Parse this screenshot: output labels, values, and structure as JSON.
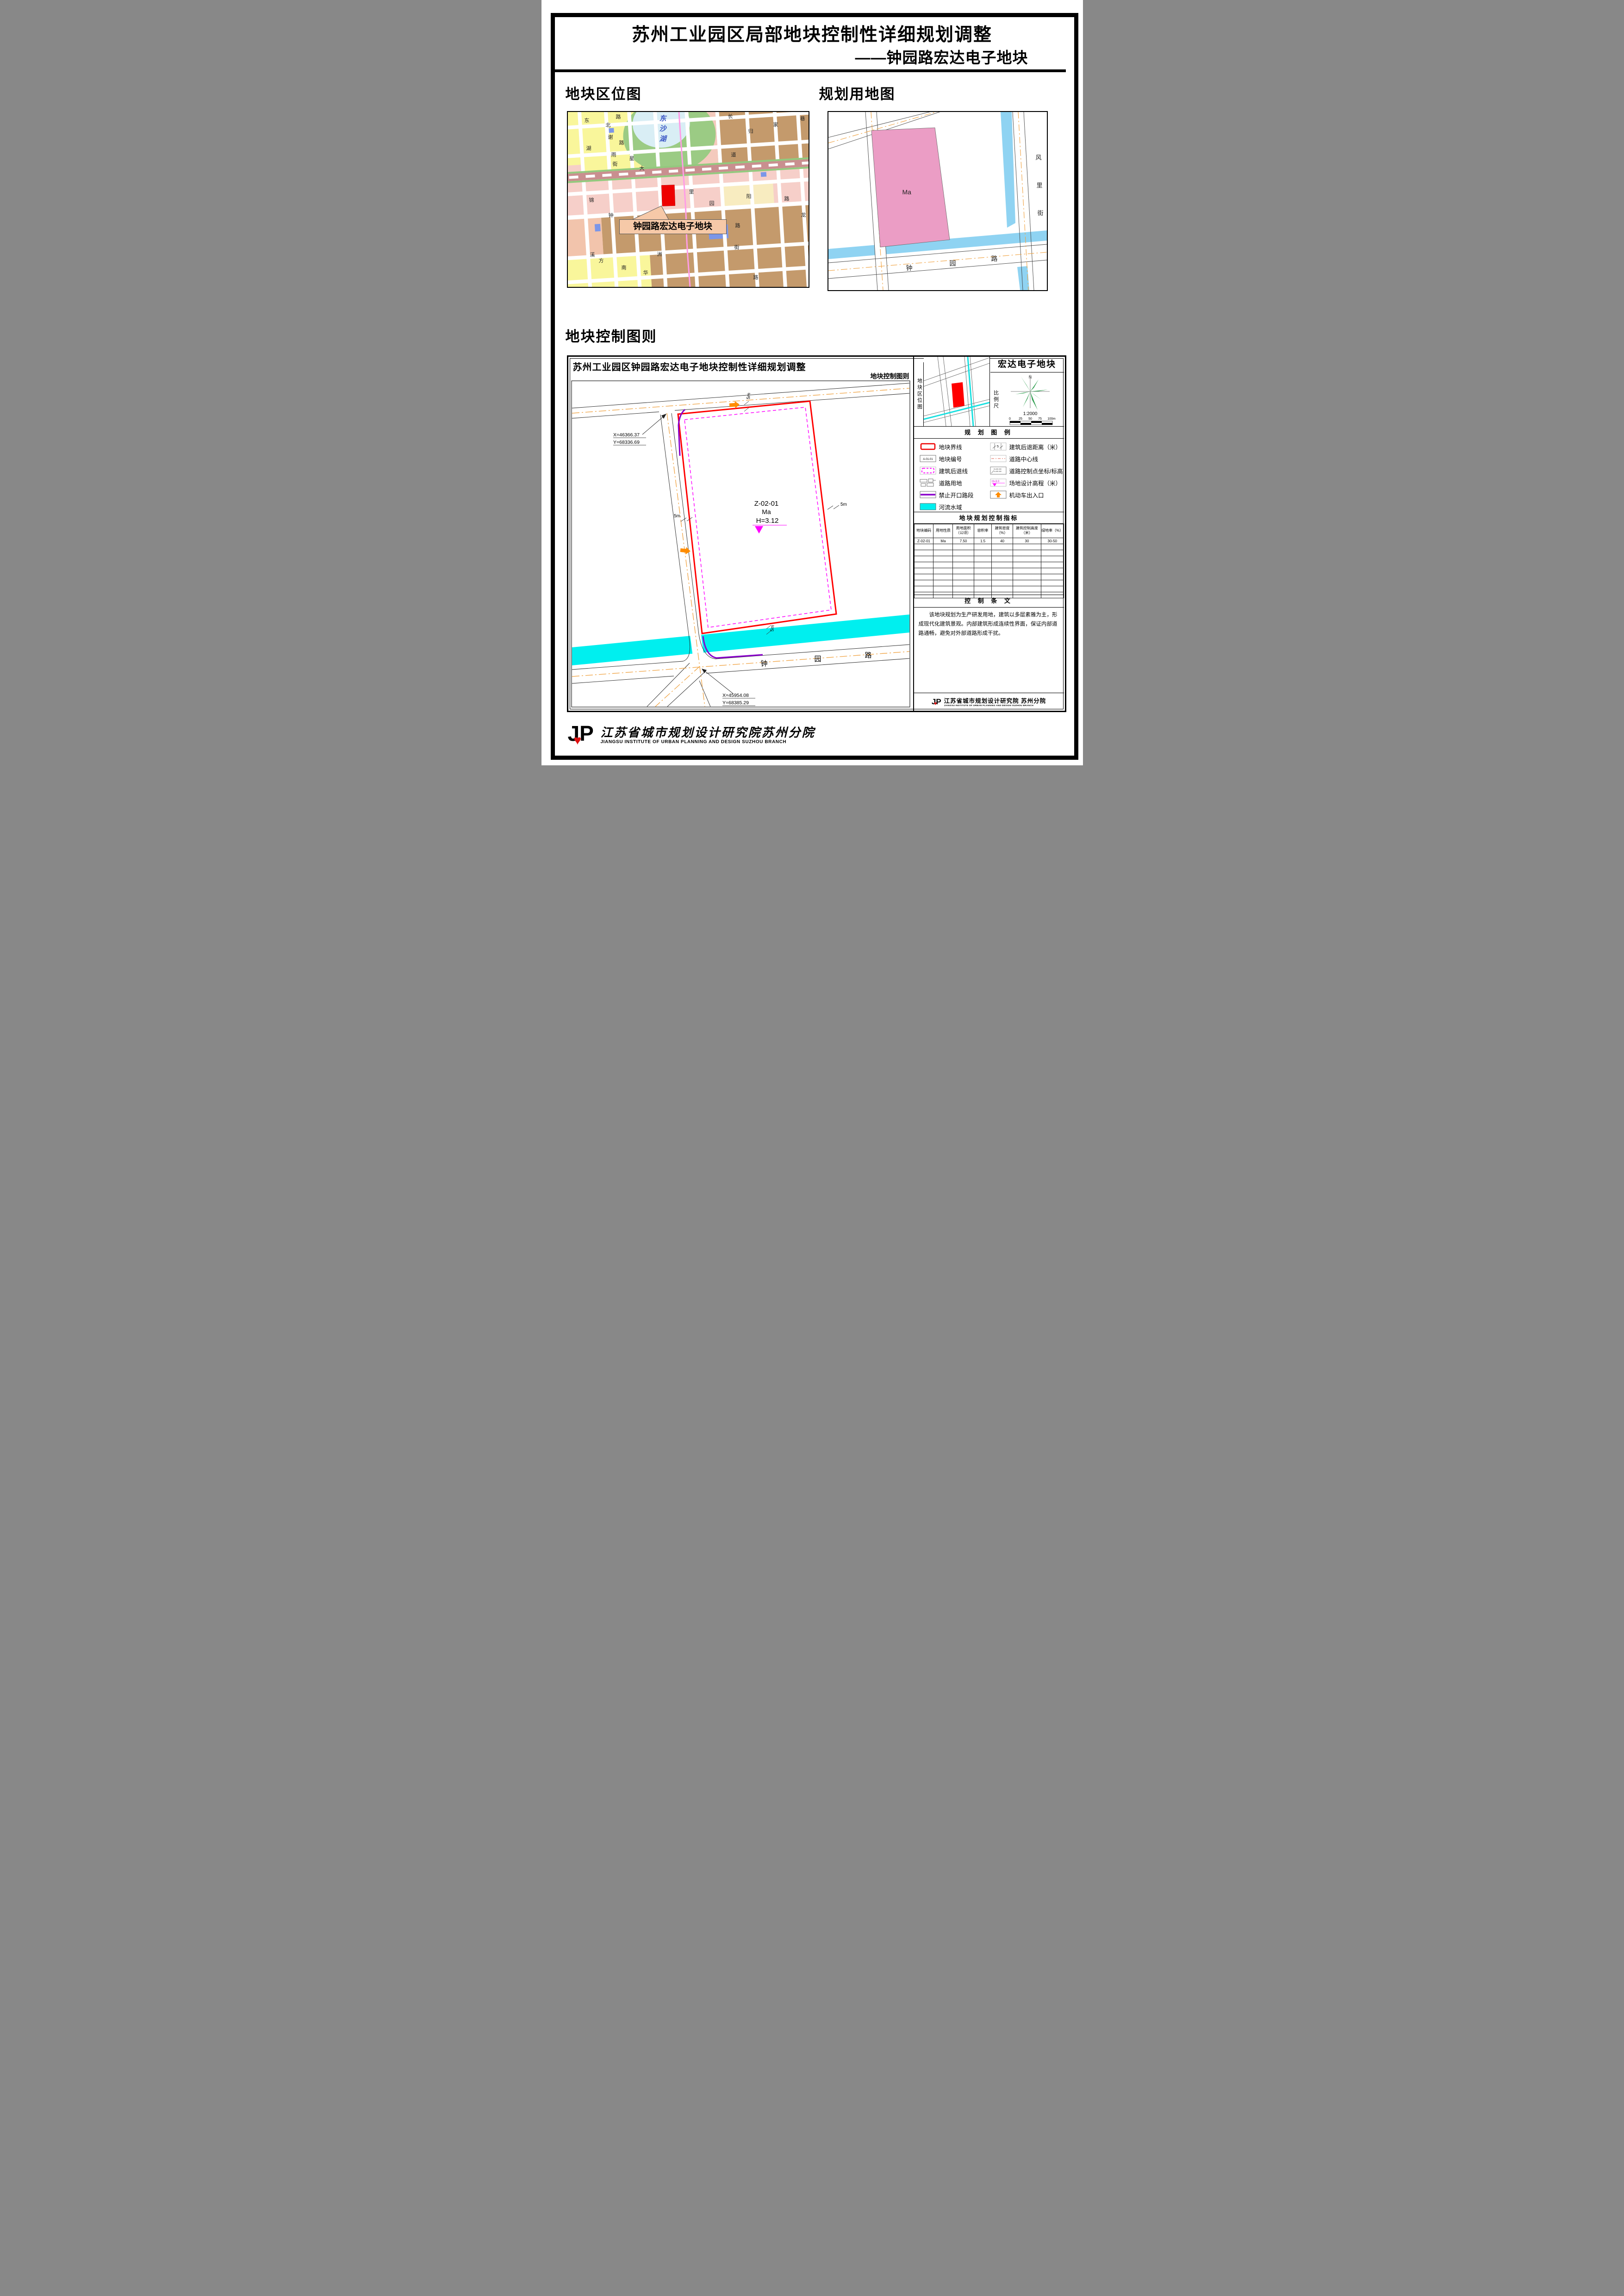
{
  "colors": {
    "plot_boundary_red": "#ff0000",
    "setback_magenta": "#ff00ff",
    "no_access_purple": "#8a00cc",
    "entrance_orange": "#ff8c00",
    "water_cyan": "#00efef",
    "canal_blue": "#8fd3f2",
    "landuse_pink": "#eb9dc5",
    "centerline_orange": "#f0a240",
    "lake_cyan": "#d9eef5",
    "parcel_brown": "#c49a6c",
    "parcel_yellow": "#f9f69b"
  },
  "header": {
    "title": "苏州工业园区局部地块控制性详细规划调整",
    "subtitle": "——钟园路宏达电子地块"
  },
  "location_map": {
    "section_title": "地块区位图",
    "lake_label": "东沙湖",
    "callout": "钟园路宏达电子地块",
    "street_labels": [
      "东",
      "路",
      "北",
      "谢",
      "路",
      "湖",
      "雨",
      "街",
      "星",
      "大",
      "道",
      "长",
      "归",
      "家",
      "巷",
      "里",
      "园",
      "阳",
      "路",
      "龙",
      "钟",
      "锦",
      "路",
      "街",
      "溪",
      "方",
      "南",
      "华",
      "洲",
      "路"
    ]
  },
  "landuse_map": {
    "section_title": "规划用地图",
    "plot_label": "Ma",
    "street_vertical": [
      "风",
      "里",
      "街"
    ],
    "street_bottom": [
      "钟",
      "园",
      "路"
    ]
  },
  "control_chart": {
    "section_title": "地块控制图则",
    "drawing_title": "苏州工业园区钟园路宏达电子地块控制性详细规划调整",
    "drawing_subtitle": "地块控制图则",
    "plot_code": "Z-02-01",
    "plot_landuse": "Ma",
    "plot_elevation": "H=3.12",
    "setback_label": "5m",
    "coord_top": {
      "x": "X=46366.37",
      "y": "Y=68336.69"
    },
    "coord_bottom": {
      "x": "X=45954.08",
      "y": "Y=68385.29"
    },
    "road_label": [
      "钟",
      "园",
      "路"
    ],
    "minimap": {
      "sidebar": "地块区位图",
      "title": "宏达电子地块",
      "scale_sidebar": "比例尺",
      "north": "N",
      "scale_ratio": "1:2000",
      "scale_ticks": [
        "0",
        "25",
        "50",
        "75",
        "100m"
      ]
    },
    "legend": {
      "header": "规 划 图 例",
      "left": [
        {
          "label": "地块界线"
        },
        {
          "label": "地块编号",
          "symbol_text": "A-01-01"
        },
        {
          "label": "建筑后退线"
        },
        {
          "label": "道路用地"
        },
        {
          "label": "禁止开口路段"
        },
        {
          "label": "河流水域"
        }
      ],
      "right": [
        {
          "label": "建筑后退距离（米）",
          "symbol_text": "5"
        },
        {
          "label": "道路中心线"
        },
        {
          "label": "道路控制点坐标/标高",
          "symbol_text_1": "X=XX.XX",
          "symbol_text_2": "Y=XX.XX"
        },
        {
          "label": "场地设计高程（米）",
          "symbol_text": "H=3.0"
        },
        {
          "label": "机动车出入口"
        }
      ]
    },
    "indicators": {
      "header": "地块规划控制指标",
      "columns": [
        "地块编码",
        "用地性质",
        "用地面积（公顷）",
        "容积率",
        "建筑密度（%）",
        "建筑控制高度（米）",
        "绿地率（%）"
      ],
      "row": [
        "Z-02-01",
        "Ma",
        "7.50",
        "1.5",
        "40",
        "30",
        "30-50"
      ]
    },
    "provisions": {
      "header": "控 制 条 文",
      "text": "该地块规划为生产研发用地，建筑以多层素雅为主，形成现代化建筑景观。内部建筑形成连续性界面，保证内部道路通畅，避免对外部道路形成干扰。"
    },
    "institute": {
      "cn": "江苏省城市规划设计研究院 苏州分院",
      "en": "JIANGSU INSTITUTE OF URBAN PLANNING AND DESIGN SUZHOU BRANCH"
    }
  },
  "footer": {
    "cn": "江苏省城市规划设计研究院苏州分院",
    "en": "JIANGSU INSTITUTE OF URBAN PLANNING AND DESIGN SUZHOU BRANCH"
  }
}
